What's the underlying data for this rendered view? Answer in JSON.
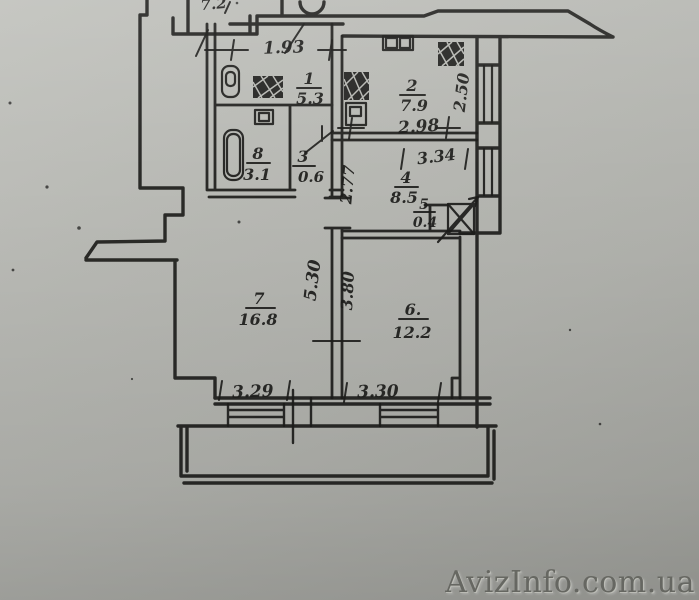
{
  "page": {
    "background_top": "#c2c3be",
    "background_bottom": "#9fa09b",
    "ink_color": "#1d1d1b"
  },
  "watermark": {
    "text": "AvizInfo.com.ua",
    "color": "#6f706a"
  },
  "plan": {
    "corner_label": "7.2",
    "rooms": [
      {
        "number": "1",
        "area": "5.3"
      },
      {
        "number": "2",
        "area": "7.9"
      },
      {
        "number": "3",
        "area": "0.6"
      },
      {
        "number": "4",
        "area": "8.5"
      },
      {
        "number": "5",
        "area": "0.4"
      },
      {
        "number": "6.",
        "area": "12.2"
      },
      {
        "number": "7",
        "area": "16.8"
      },
      {
        "number": "8",
        "area": "3.1"
      }
    ],
    "dimensions": {
      "entry_width": "1.93",
      "kitchen_width": "2.98",
      "kitchen_depth": "2.50",
      "room4_width": "3.34",
      "room4_depth": "2.77",
      "room7_depth": "5.30",
      "room6_depth": "3.80",
      "room7_width": "3.29",
      "room6_width": "3.30"
    }
  }
}
